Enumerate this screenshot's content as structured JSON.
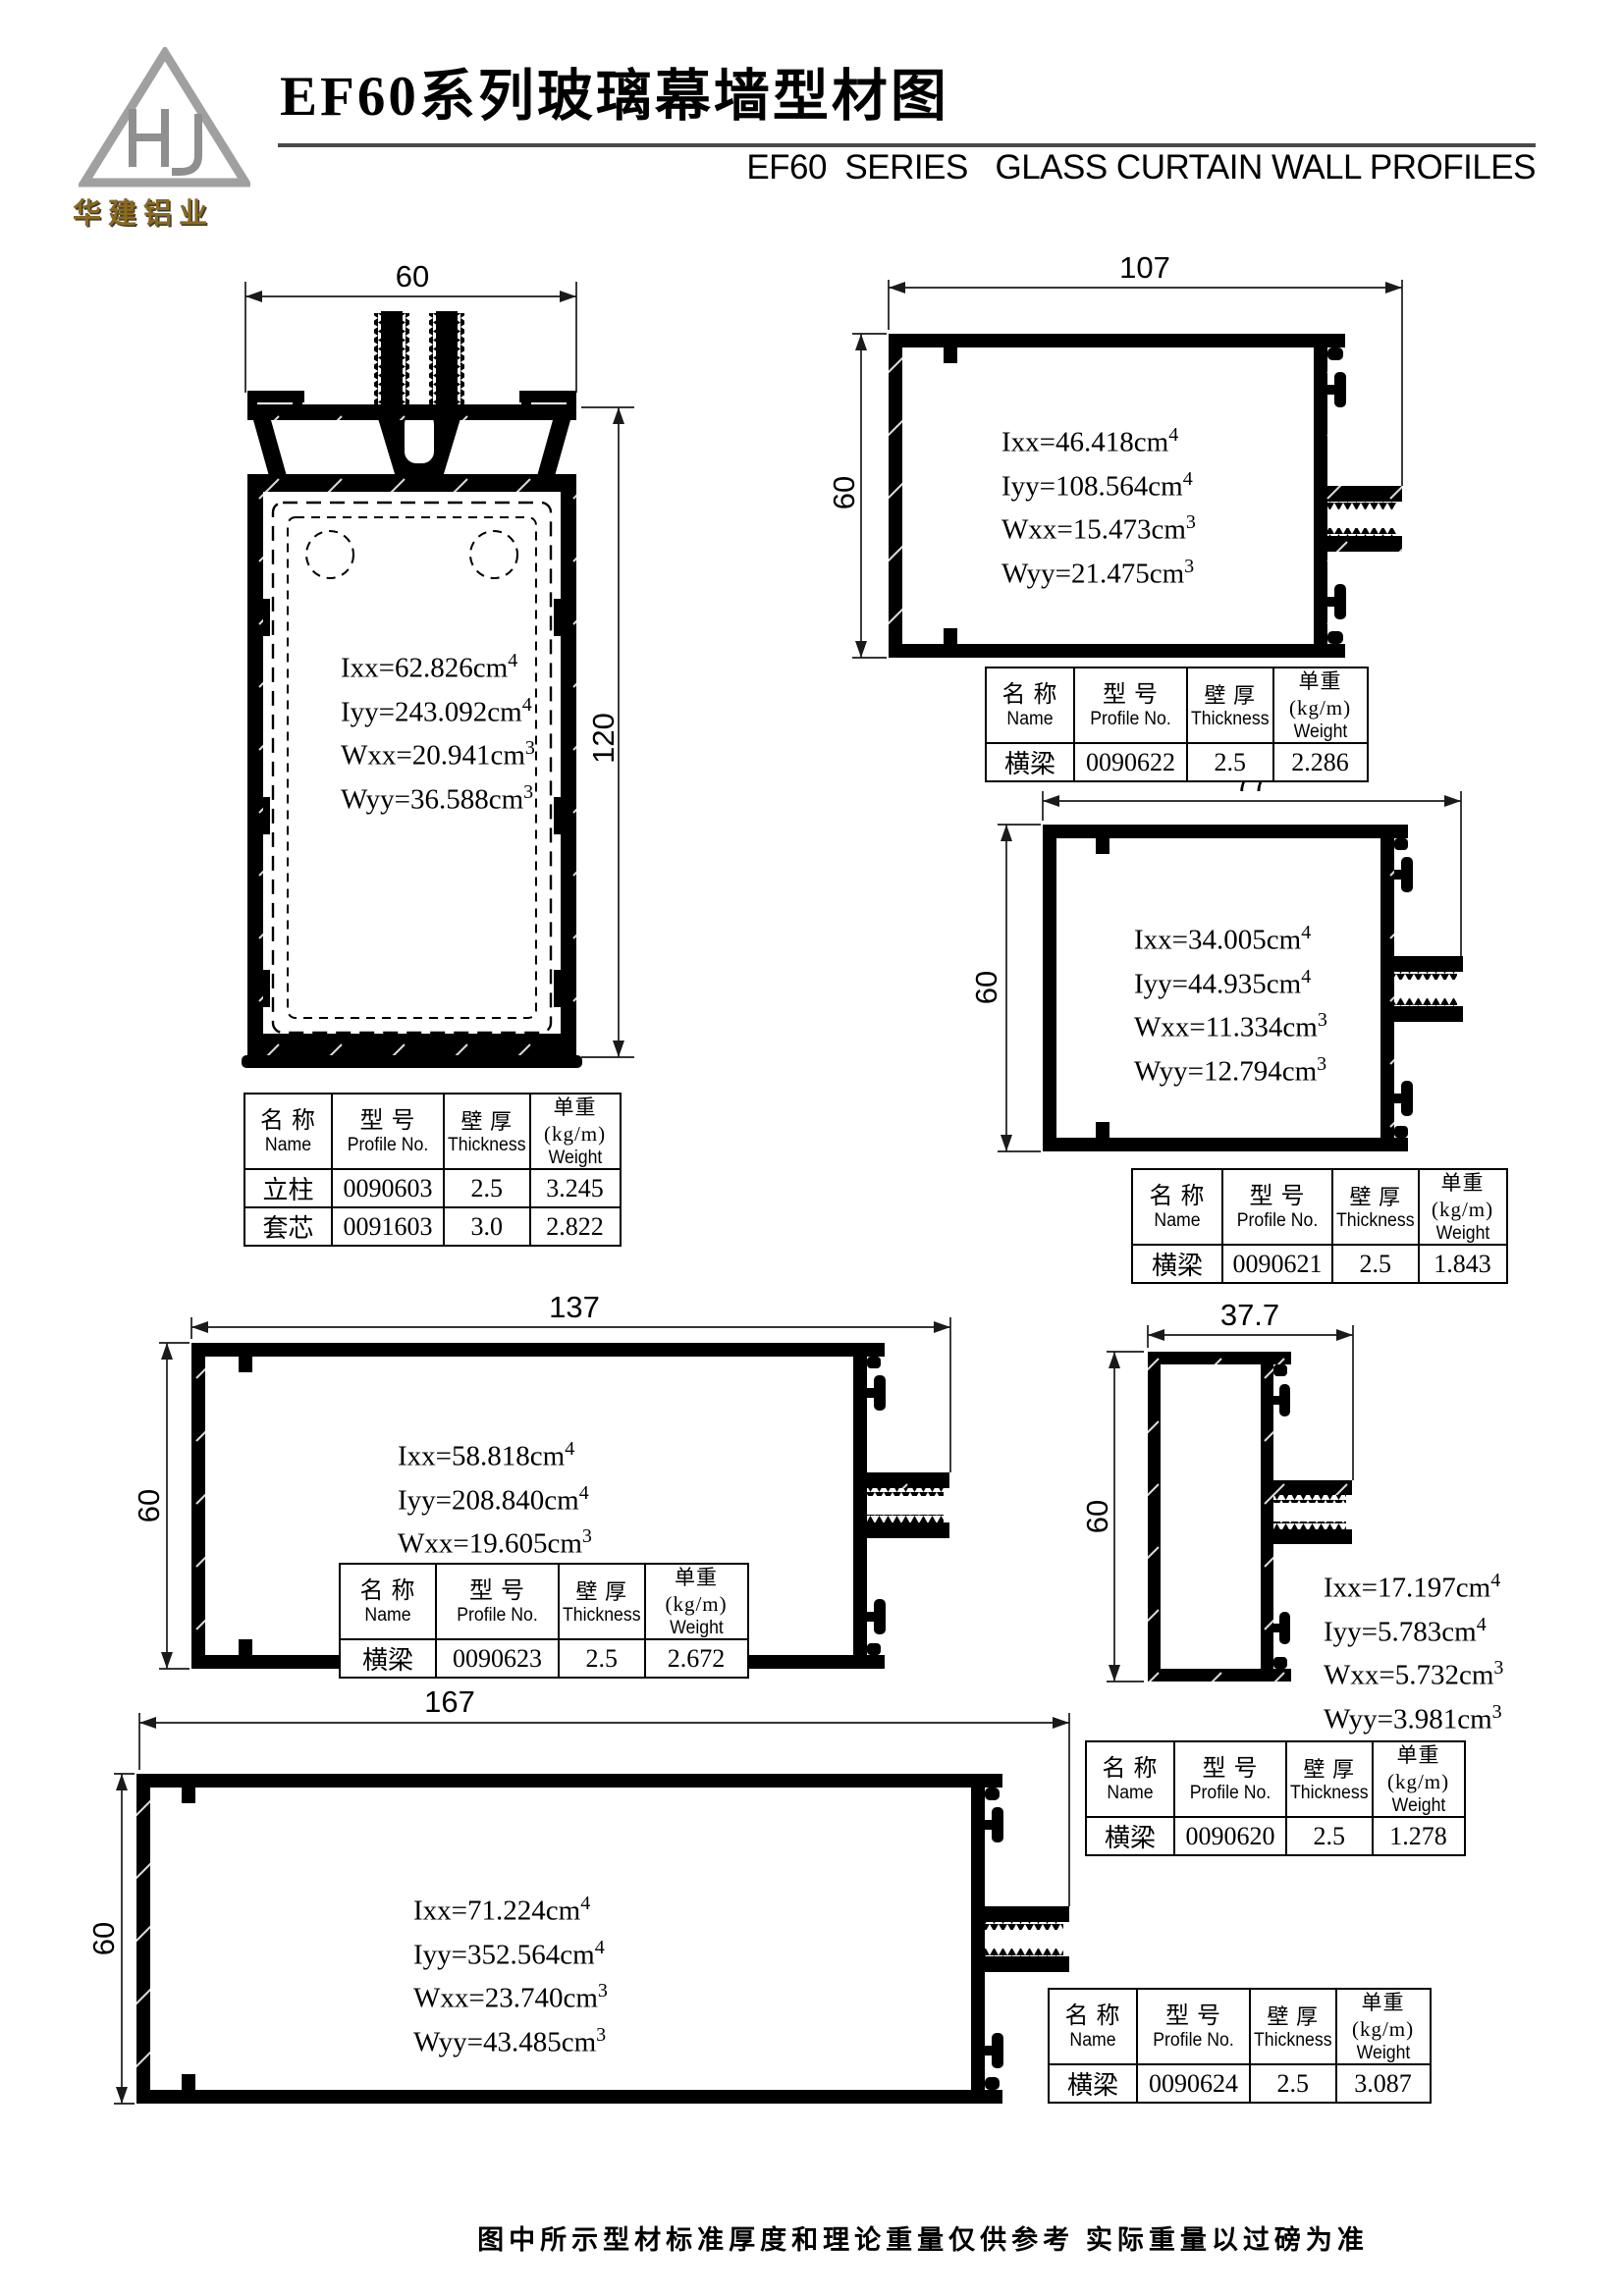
{
  "header": {
    "logo_text": "华建铝业",
    "title": "EF60系列玻璃幕墙型材图",
    "subtitle": "EF60  SERIES   GLASS CURTAIN WALL PROFILES"
  },
  "table_headers": {
    "name_zh": "名 称",
    "name_en": "Name",
    "no_zh": "型 号",
    "no_en": "Profile No.",
    "thick_zh": "壁 厚",
    "thick_en": "Thickness",
    "weight_zh": "单重(kg/m)",
    "weight_en": "Weight"
  },
  "profiles": [
    {
      "id": "mullion-60x120",
      "dims": {
        "w": "60",
        "h": "120"
      },
      "props": [
        {
          "v": "Ixx=62.826cm",
          "e": "4"
        },
        {
          "v": "Iyy=243.092cm",
          "e": "4"
        },
        {
          "v": "Wxx=20.941cm",
          "e": "3"
        },
        {
          "v": "Wyy=36.588cm",
          "e": "3"
        }
      ],
      "rows": [
        [
          "立柱",
          "0090603",
          "2.5",
          "3.245"
        ],
        [
          "套芯",
          "0091603",
          "3.0",
          "2.822"
        ]
      ]
    },
    {
      "id": "transom-107x60",
      "dims": {
        "w": "107",
        "h": "60"
      },
      "props": [
        {
          "v": "Ixx=46.418cm",
          "e": "4"
        },
        {
          "v": "Iyy=108.564cm",
          "e": "4"
        },
        {
          "v": "Wxx=15.473cm",
          "e": "3"
        },
        {
          "v": "Wyy=21.475cm",
          "e": "3"
        }
      ],
      "rows": [
        [
          "横梁",
          "0090622",
          "2.5",
          "2.286"
        ]
      ]
    },
    {
      "id": "transom-77x60",
      "dims": {
        "w": "77",
        "h": "60"
      },
      "props": [
        {
          "v": "Ixx=34.005cm",
          "e": "4"
        },
        {
          "v": "Iyy=44.935cm",
          "e": "4"
        },
        {
          "v": "Wxx=11.334cm",
          "e": "3"
        },
        {
          "v": "Wyy=12.794cm",
          "e": "3"
        }
      ],
      "rows": [
        [
          "横梁",
          "0090621",
          "2.5",
          "1.843"
        ]
      ]
    },
    {
      "id": "transom-137x60",
      "dims": {
        "w": "137",
        "h": "60"
      },
      "props": [
        {
          "v": "Ixx=58.818cm",
          "e": "4"
        },
        {
          "v": "Iyy=208.840cm",
          "e": "4"
        },
        {
          "v": "Wxx=19.605cm",
          "e": "3"
        },
        {
          "v": "Wyy=31.711cm",
          "e": "3"
        }
      ],
      "rows": [
        [
          "横梁",
          "0090623",
          "2.5",
          "2.672"
        ]
      ]
    },
    {
      "id": "transom-37.7x60",
      "dims": {
        "w": "37.7",
        "h": "60"
      },
      "props": [
        {
          "v": "Ixx=17.197cm",
          "e": "4"
        },
        {
          "v": "Iyy=5.783cm",
          "e": "4"
        },
        {
          "v": "Wxx=5.732cm",
          "e": "3"
        },
        {
          "v": "Wyy=3.981cm",
          "e": "3"
        }
      ],
      "rows": [
        [
          "横梁",
          "0090620",
          "2.5",
          "1.278"
        ]
      ]
    },
    {
      "id": "transom-167x60",
      "dims": {
        "w": "167",
        "h": "60"
      },
      "props": [
        {
          "v": "Ixx=71.224cm",
          "e": "4"
        },
        {
          "v": "Iyy=352.564cm",
          "e": "4"
        },
        {
          "v": "Wxx=23.740cm",
          "e": "3"
        },
        {
          "v": "Wyy=43.485cm",
          "e": "3"
        }
      ],
      "rows": [
        [
          "横梁",
          "0090624",
          "2.5",
          "3.087"
        ]
      ]
    }
  ],
  "footer": "图中所示型材标准厚度和理论重量仅供参考 实际重量以过磅为准"
}
